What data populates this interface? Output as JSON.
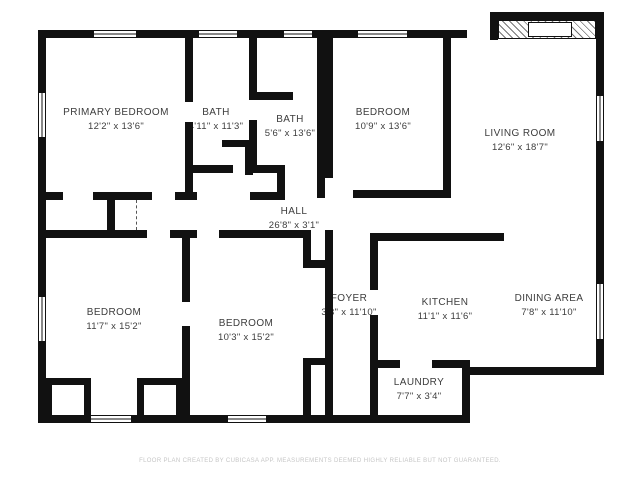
{
  "floorplan": {
    "rooms": [
      {
        "id": "primary-bedroom",
        "name": "PRIMARY BEDROOM",
        "dims": "12'2\" x 13'6\""
      },
      {
        "id": "bath-1",
        "name": "BATH",
        "dims": "4'11\" x 11'3\""
      },
      {
        "id": "bath-2",
        "name": "BATH",
        "dims": "5'6\" x 13'6\""
      },
      {
        "id": "bedroom-top",
        "name": "BEDROOM",
        "dims": "10'9\" x 13'6\""
      },
      {
        "id": "living-room",
        "name": "LIVING ROOM",
        "dims": "12'6\" x 18'7\""
      },
      {
        "id": "hall",
        "name": "HALL",
        "dims": "26'8\" x 3'1\""
      },
      {
        "id": "bedroom-left",
        "name": "BEDROOM",
        "dims": "11'7\" x 15'2\""
      },
      {
        "id": "bedroom-middle",
        "name": "BEDROOM",
        "dims": "10'3\" x 15'2\""
      },
      {
        "id": "foyer",
        "name": "FOYER",
        "dims": "3'3\" x 11'10\""
      },
      {
        "id": "kitchen",
        "name": "KITCHEN",
        "dims": "11'1\" x 11'6\""
      },
      {
        "id": "dining-area",
        "name": "DINING AREA",
        "dims": "7'8\" x 11'10\""
      },
      {
        "id": "laundry",
        "name": "LAUNDRY",
        "dims": "7'7\" x 3'4\""
      }
    ],
    "footer": "FLOOR PLAN CREATED BY CUBICASA APP. MEASUREMENTS DEEMED HIGHLY RELIABLE BUT NOT GUARANTEED.",
    "colors": {
      "wall": "#111111",
      "background": "#ffffff",
      "label": "#3d3d3d",
      "footer": "#c6c6c6"
    }
  }
}
